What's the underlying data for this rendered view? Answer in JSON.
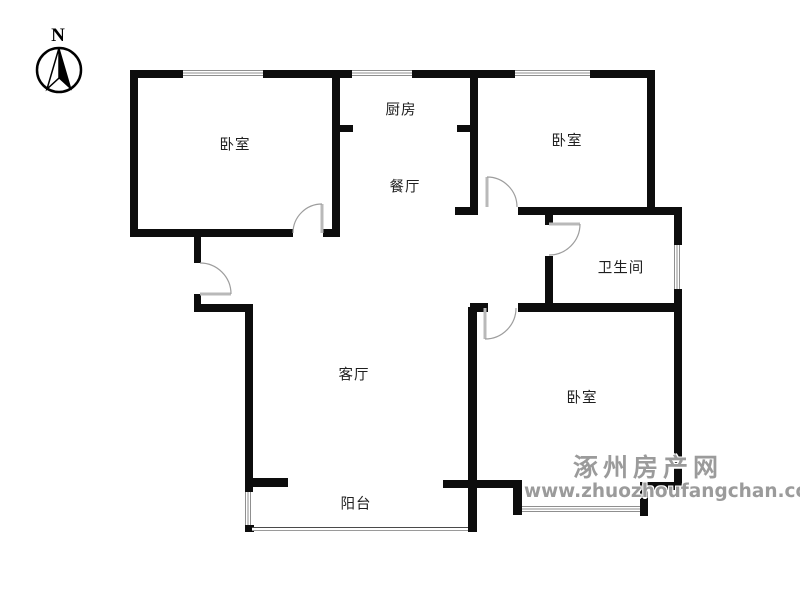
{
  "compass": {
    "label": "N"
  },
  "rooms": {
    "bedroom_nw": {
      "label": "卧室"
    },
    "kitchen": {
      "label": "厨房"
    },
    "dining": {
      "label": "餐厅"
    },
    "bedroom_ne": {
      "label": "卧室"
    },
    "bathroom": {
      "label": "卫生间"
    },
    "living": {
      "label": "客厅"
    },
    "bedroom_se": {
      "label": "卧室"
    },
    "balcony": {
      "label": "阳台"
    }
  },
  "watermark": {
    "site_name": "涿州房产网",
    "site_url": "www.zhuozhoufangchan.com",
    "color": "#9b9b9b"
  },
  "colors": {
    "wall": "#0d0d0d",
    "door": "#aaaaaa",
    "window_line": "#8f8f8f",
    "background": "#ffffff"
  }
}
